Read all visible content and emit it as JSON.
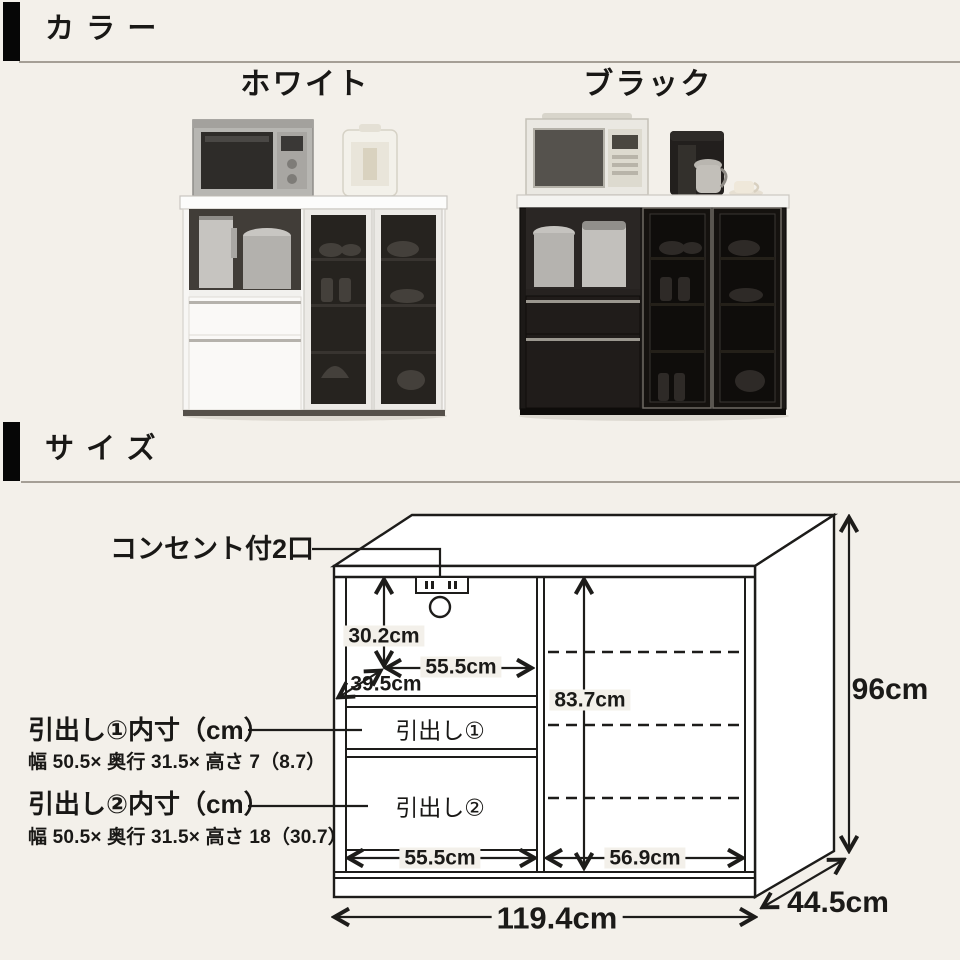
{
  "colors": {
    "background": "#f3f0ea",
    "line": "#1d1c1a",
    "header_bar": "#060606",
    "divider": "#a59f96",
    "white_cabinet_body": "#f8f7f5",
    "black_cabinet_body": "#1c1917"
  },
  "color_section": {
    "title": "カラー",
    "variants": [
      {
        "name": "white",
        "label": "ホワイト"
      },
      {
        "name": "black",
        "label": "ブラック"
      }
    ]
  },
  "size_section": {
    "title": "サイズ"
  },
  "diagram": {
    "outlet_label": "コンセント付2口",
    "drawer1_title": "引出し①内寸（cm）",
    "drawer1_spec": "幅 50.5× 奥行 31.5× 高さ 7（8.7）",
    "drawer2_title": "引出し②内寸（cm）",
    "drawer2_spec": "幅 50.5× 奥行 31.5× 高さ 18（30.7）",
    "drawer1_label": "引出し①",
    "drawer2_label": "引出し②",
    "dim_inner_height_left": "30.2cm",
    "dim_inner_width_left": "55.5cm",
    "dim_inner_depth": "39.5cm",
    "dim_inner_height_right": "83.7cm",
    "dim_bottom_width_left": "55.5cm",
    "dim_bottom_width_right": "56.9cm",
    "dim_total_width": "119.4cm",
    "dim_total_depth": "44.5cm",
    "dim_total_height": "96cm"
  }
}
